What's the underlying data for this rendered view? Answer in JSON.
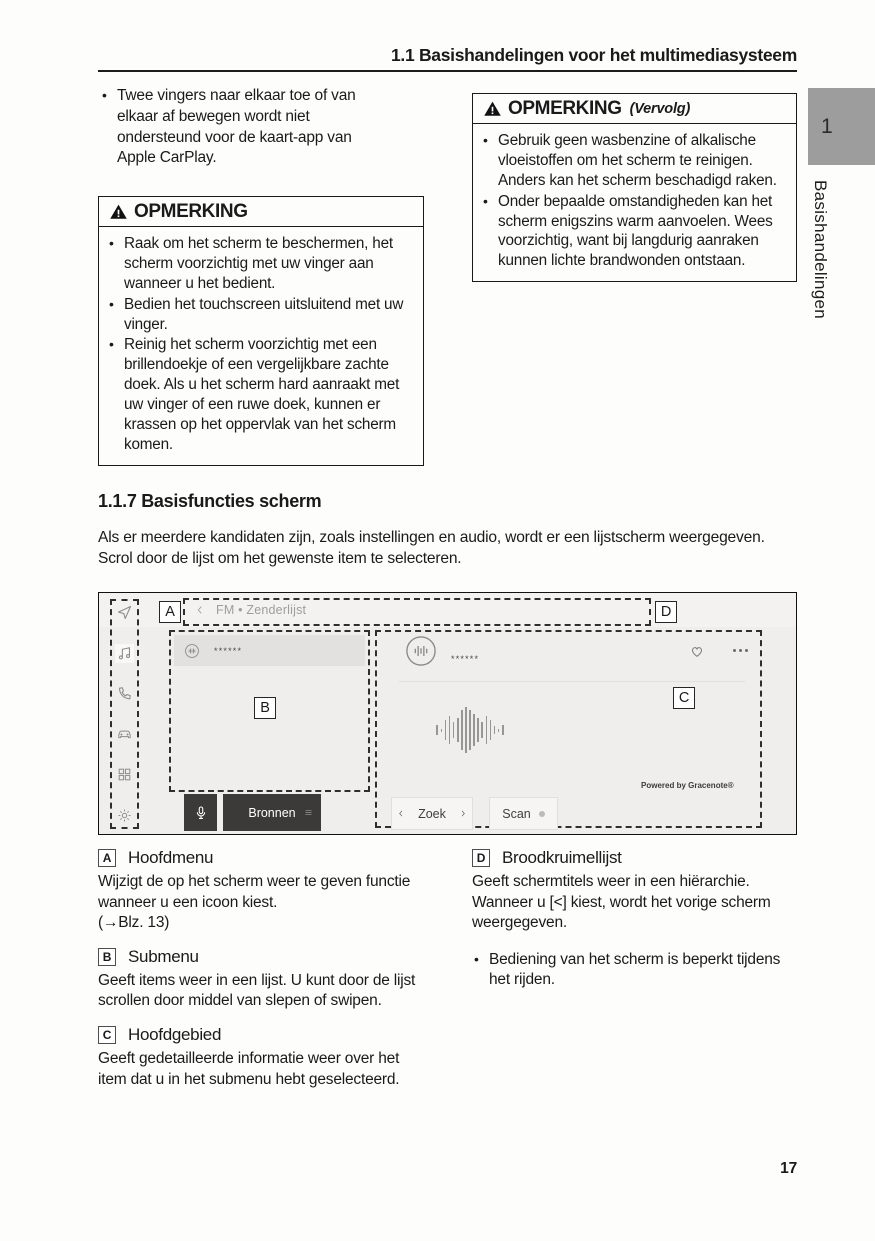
{
  "page": {
    "header_title": "1.1  Basishandelingen voor het multimediasysteem",
    "page_number": "17",
    "chapter_tab_number": "1",
    "chapter_tab_label": "Basishandelingen"
  },
  "colors": {
    "tab_gray": "#9d9d9d",
    "screen_background": "#efeeec",
    "selected_row": "#e2e1df",
    "dark_button": "#3b3a39",
    "text": "#1a1a1a"
  },
  "intro_bullet": "Twee vingers naar elkaar toe of van elkaar af bewegen wordt niet ondersteund voor de kaart-app van Apple CarPlay.",
  "notice_left": {
    "title": "OPMERKING",
    "warning_icon": "warning-triangle-icon",
    "bullets": [
      "Raak om het scherm te beschermen, het scherm voorzichtig met uw vinger aan wanneer u het bedient.",
      "Bedien het touchscreen uitsluitend met uw vinger.",
      "Reinig het scherm voorzichtig met een brillendoekje of een vergelijkbare zachte doek. Als u het scherm hard aanraakt met uw vinger of een ruwe doek, kunnen er krassen op het oppervlak van het scherm komen."
    ]
  },
  "notice_right": {
    "title": "OPMERKING",
    "continuation": "(Vervolg)",
    "warning_icon": "warning-triangle-icon",
    "bullets": [
      "Gebruik geen wasbenzine of alkalische vloeistoffen om het scherm te reinigen. Anders kan het scherm beschadigd raken.",
      "Onder bepaalde omstandigheden kan het scherm enigszins warm aanvoelen. Wees voorzichtig, want bij langdurig aanraken kunnen lichte brandwonden ontstaan."
    ]
  },
  "section": {
    "heading": "1.1.7  Basisfuncties scherm",
    "intro": "Als er meerdere kandidaten zijn, zoals instellingen en audio, wordt er een lijstscherm weergegeven. Scrol door de lijst om het gewenste item te selecteren."
  },
  "screenshot": {
    "labels": {
      "a": "A",
      "b": "B",
      "c": "C",
      "d": "D"
    },
    "breadcrumb": "FM • Zenderlijst",
    "back_icon": "chevron-left-icon",
    "sidebar_icons": [
      "navigation-icon",
      "music-icon",
      "phone-icon",
      "car-icon",
      "apps-grid-icon",
      "settings-icon"
    ],
    "submenu_item_text": "******",
    "main_item_text": "******",
    "favorite_icon": "heart-icon",
    "overflow_icon": "more-menu-icon",
    "powered_by": "Powered by Gracenote®",
    "waveform_bars": [
      10,
      3,
      20,
      28,
      16,
      24,
      40,
      46,
      40,
      32,
      24,
      16,
      28,
      20,
      8,
      3,
      10
    ],
    "buttons": {
      "mic_icon": "microphone-icon",
      "sources": "Bronnen",
      "seek": "Zoek",
      "scan": "Scan"
    }
  },
  "legend_left": [
    {
      "key": "A",
      "title": "Hoofdmenu",
      "body": "Wijzigt de op het scherm weer te geven functie wanneer u een icoon kiest.",
      "ref": "(→Blz. 13)"
    },
    {
      "key": "B",
      "title": "Submenu",
      "body": "Geeft items weer in een lijst. U kunt door de lijst scrollen door middel van slepen of swipen."
    },
    {
      "key": "C",
      "title": "Hoofdgebied",
      "body": "Geeft gedetailleerde informatie weer over het item dat u in het submenu hebt geselecteerd."
    }
  ],
  "legend_right": [
    {
      "key": "D",
      "title": "Broodkruimellijst",
      "body": "Geeft schermtitels weer in een hiërarchie. Wanneer u [<] kiest, wordt het vorige scherm weergegeven."
    }
  ],
  "legend_right_note": "Bediening van het scherm is beperkt tijdens het rijden."
}
